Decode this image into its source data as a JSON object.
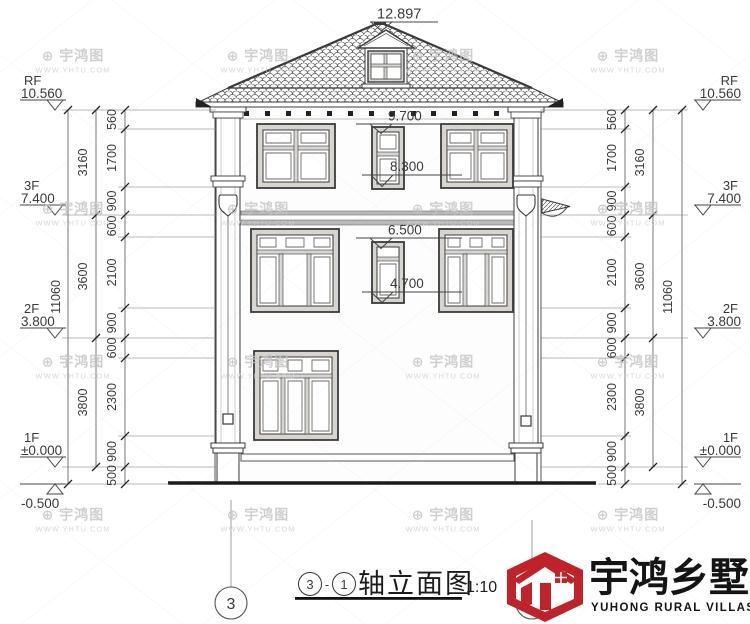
{
  "colors": {
    "line": "#3a3a3a",
    "accent_red": "#bf2329",
    "band_gray": "#b9b9b9",
    "watermark_gray": "#d7d7d7"
  },
  "roof": {
    "peak_elevation": "12.897"
  },
  "facade_marks": [
    "9.700",
    "8.300",
    "6.500",
    "4.700"
  ],
  "levels": [
    {
      "label": "RF",
      "value": "10.560"
    },
    {
      "label": "3F",
      "value": "7.400"
    },
    {
      "label": "2F",
      "value": "3.800"
    },
    {
      "label": "1F",
      "value": "±0.000"
    },
    {
      "label": "",
      "value": "-0.500"
    }
  ],
  "dims": {
    "total": "11060",
    "floors": [
      "3160",
      "3600",
      "3800"
    ],
    "detail": [
      "560",
      "1700",
      "900",
      "600",
      "2100",
      "900",
      "600",
      "2300",
      "900",
      "500"
    ]
  },
  "axes": {
    "a3": "3",
    "a1": "1"
  },
  "title": {
    "axis_from": "3",
    "dash": "-",
    "axis_to": "1",
    "name": "轴立面图",
    "scale": "1:10"
  },
  "logo": {
    "zh": "宇鸿乡墅",
    "en": "YUHONG RURAL VILLAS"
  },
  "watermark": {
    "icon": "⊕",
    "brand": "宇鸿图",
    "url": "WWW.YHTU.COM"
  }
}
